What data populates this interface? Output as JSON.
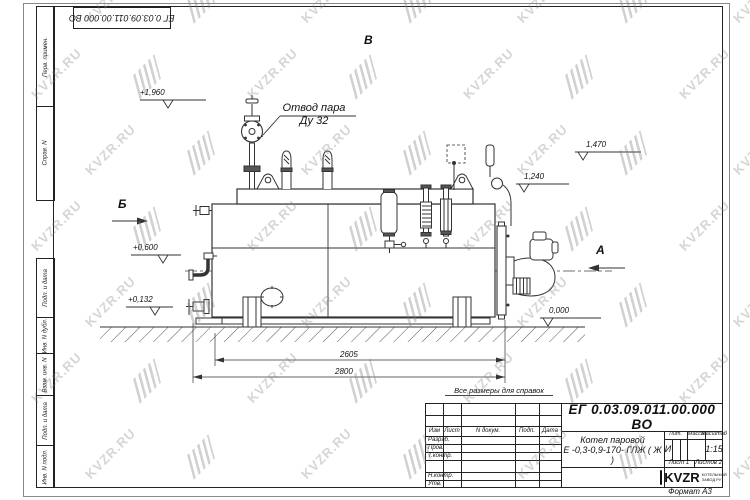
{
  "watermark": {
    "text": "KVZR.RU"
  },
  "corner_stamp": {
    "doc_number": "ЕГ 0.03.09.011.00.000  ВО"
  },
  "side_stamps": {
    "upper": [
      "Перв. примен.",
      "Справ. N"
    ],
    "lower": [
      "Подп. и дата",
      "Инв. N дубл.",
      "Взам. инв. N",
      "Подп. и дата",
      "Инв. N подл."
    ]
  },
  "drawing": {
    "callout": {
      "line1": "Отвод пара",
      "line2": "Ду 32"
    },
    "views": {
      "v": "В",
      "b": "Б",
      "a": "А"
    },
    "elevations": {
      "e1960": "+1,960",
      "e1470": "1,470",
      "e1240": "1,240",
      "e0600": "+0,600",
      "e0132": "+0,132",
      "e0000": "0,000"
    },
    "dimensions": {
      "d2605": "2605",
      "d2800": "2800"
    },
    "note": "Все размеры для справок"
  },
  "title_block": {
    "doc_number": "ЕГ 0.03.09.011.00.000  ВО",
    "name_line1": "Котел паровой",
    "name_line2": "Е -0,3-0,9-170- ГЛЖ ( Ж )",
    "header_cols": [
      "Изм",
      "Лист",
      "N докум.",
      "Подп.",
      "Дата"
    ],
    "rows": [
      "Разраб.",
      "Пров.",
      "Т.контр.",
      "Н.контр.",
      "Утв."
    ],
    "lit_label": "Лит.",
    "lit_value": "И",
    "massa_label": "Масса",
    "scale_label": "Масштаб",
    "scale_value": "1:15",
    "sheet_text": "Лист 1",
    "sheets_text": "Листов 2",
    "logo_text": "KVZR",
    "logo_sub1": "КОТЕЛЬНЫЙ",
    "logo_sub2": "ЗАВОД.РУ",
    "format": "Формат А3"
  }
}
